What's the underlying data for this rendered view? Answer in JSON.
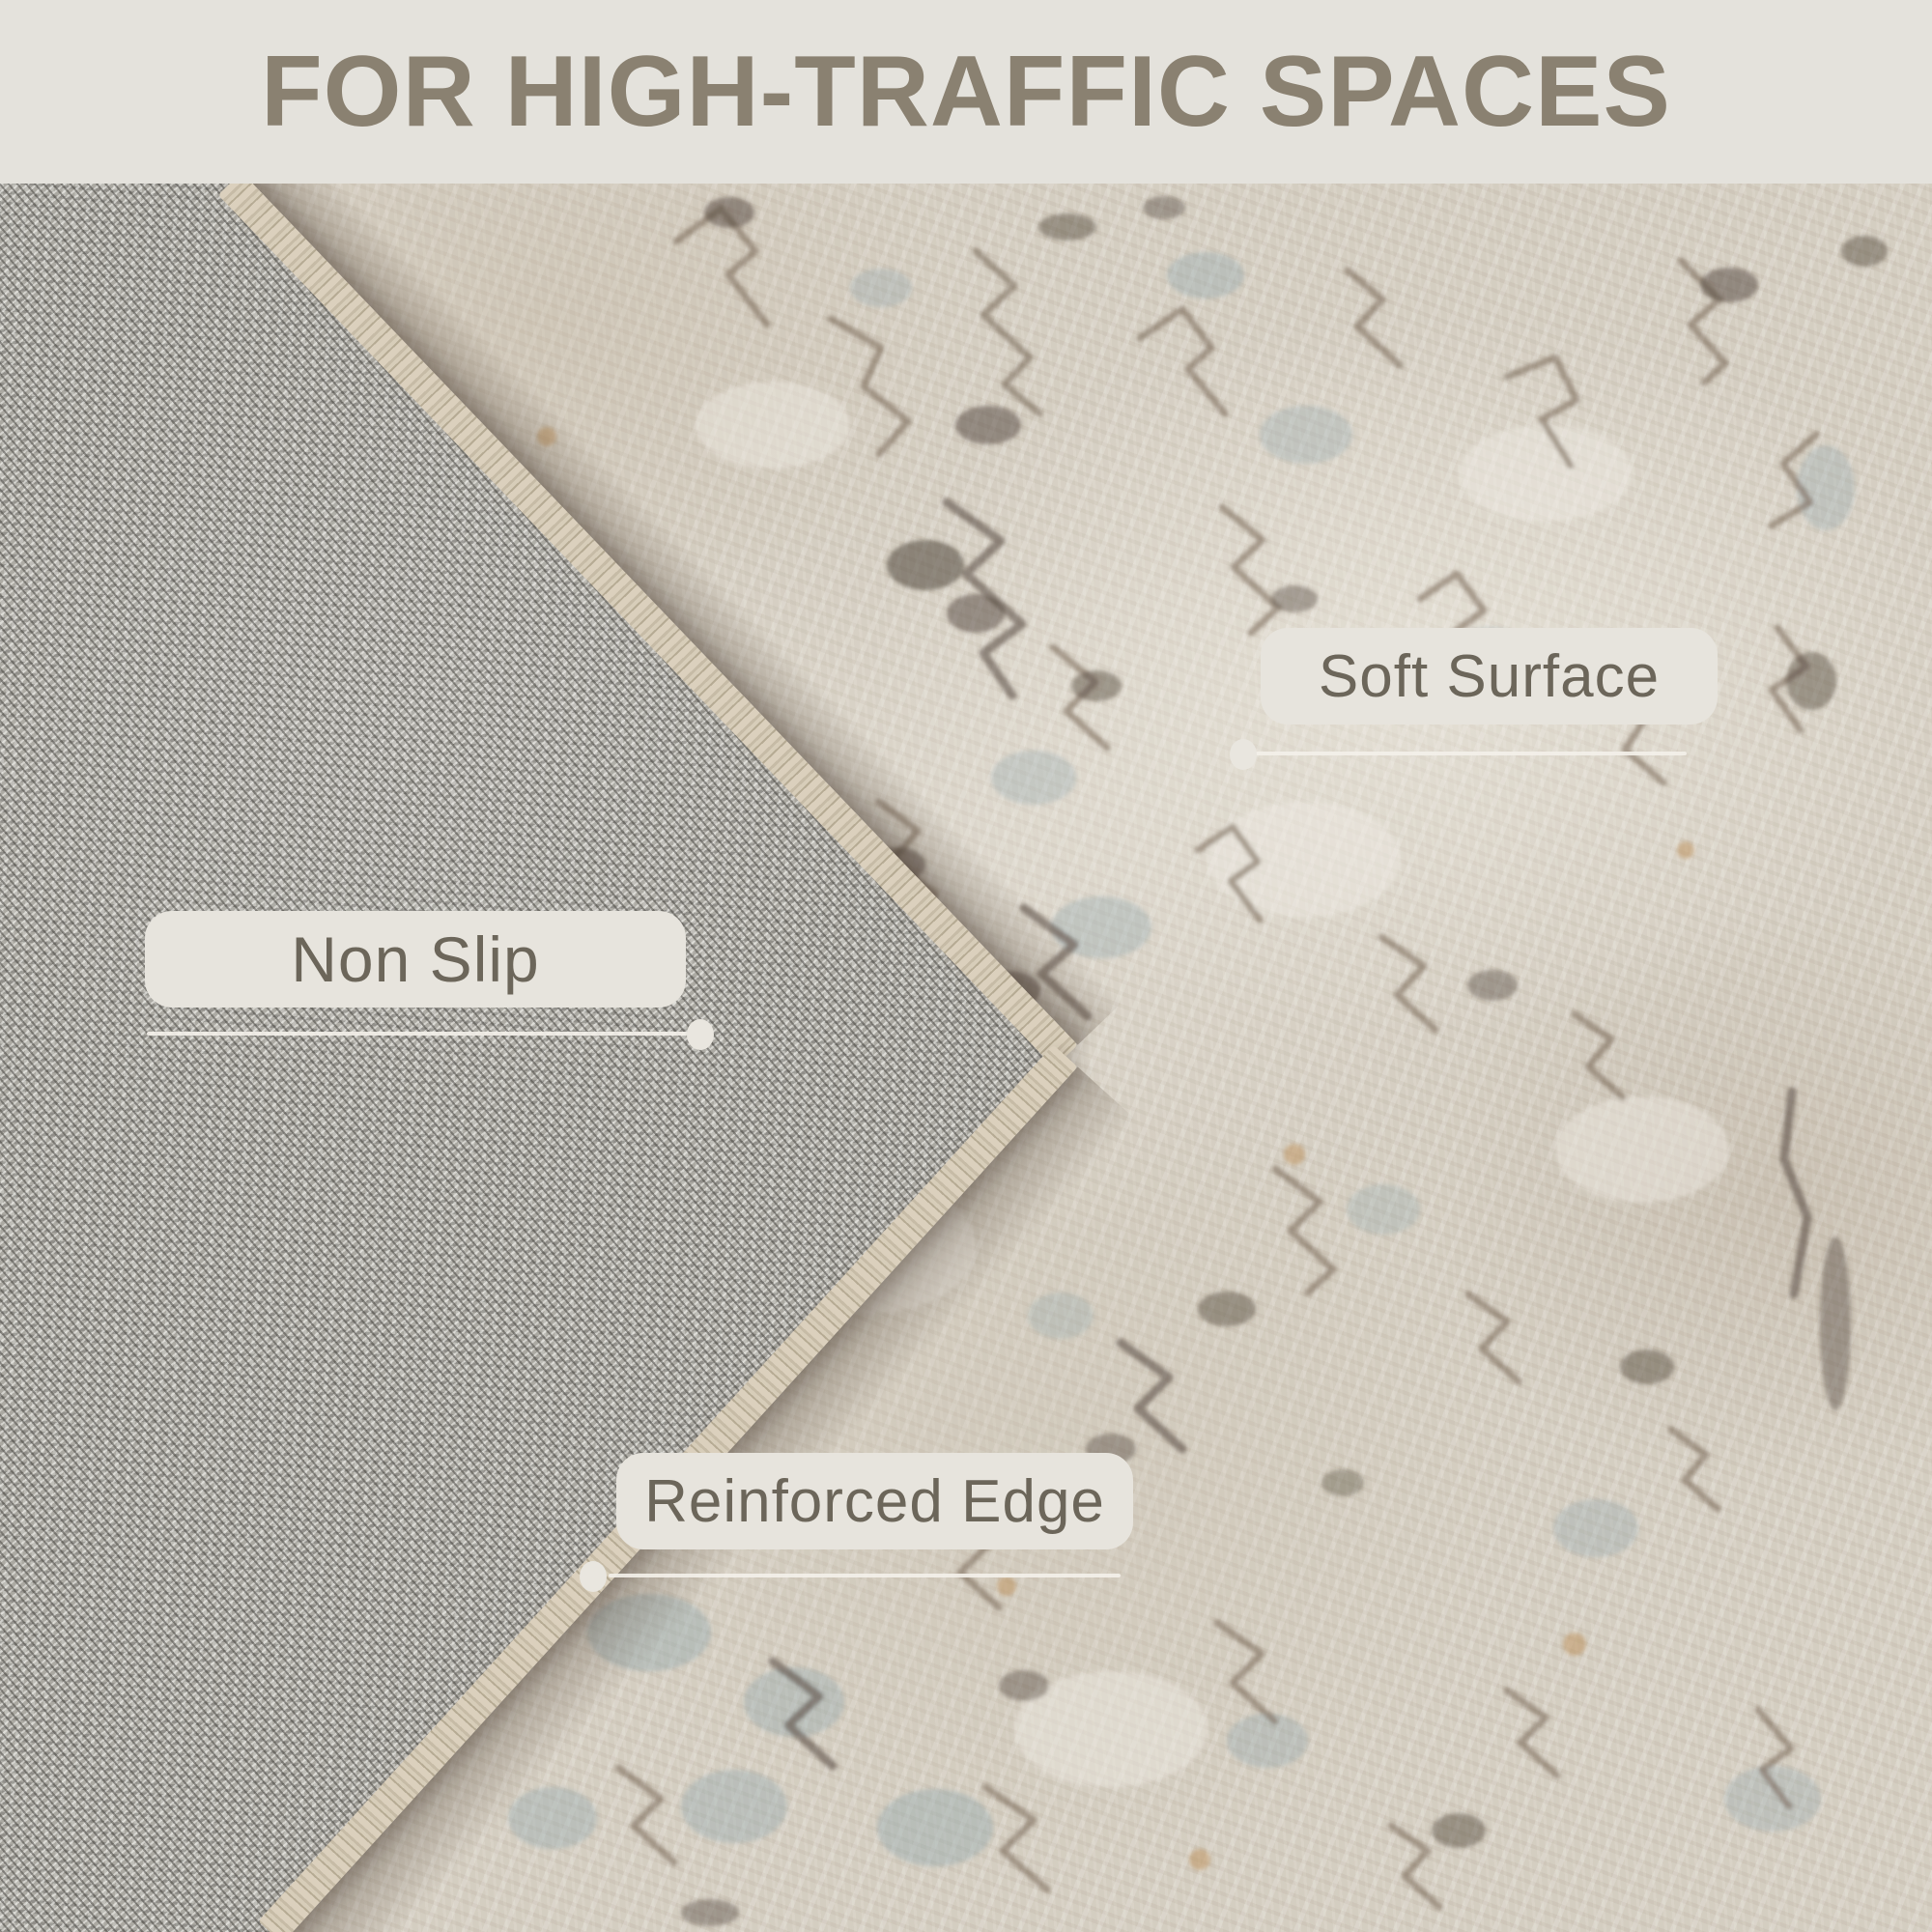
{
  "header": {
    "title": "FOR HIGH-TRAFFIC SPACES"
  },
  "callouts": {
    "soft_surface": {
      "label": "Soft Surface"
    },
    "non_slip": {
      "label": "Non Slip"
    },
    "reinforced_edge": {
      "label": "Reinforced Edge"
    }
  },
  "colors": {
    "header_background": "#e4e2dc",
    "title_text": "#8a8171",
    "callout_background": "#e7e4dd",
    "callout_text": "#6c665a",
    "callout_line": "#f3f0e9",
    "rug_front_base": "#d3ccc0",
    "rug_back_base": "#a7a59f",
    "serged_edge": "#d0c5b0",
    "motif_brown": "#6b5948",
    "motif_blue": "#87a0a8"
  }
}
